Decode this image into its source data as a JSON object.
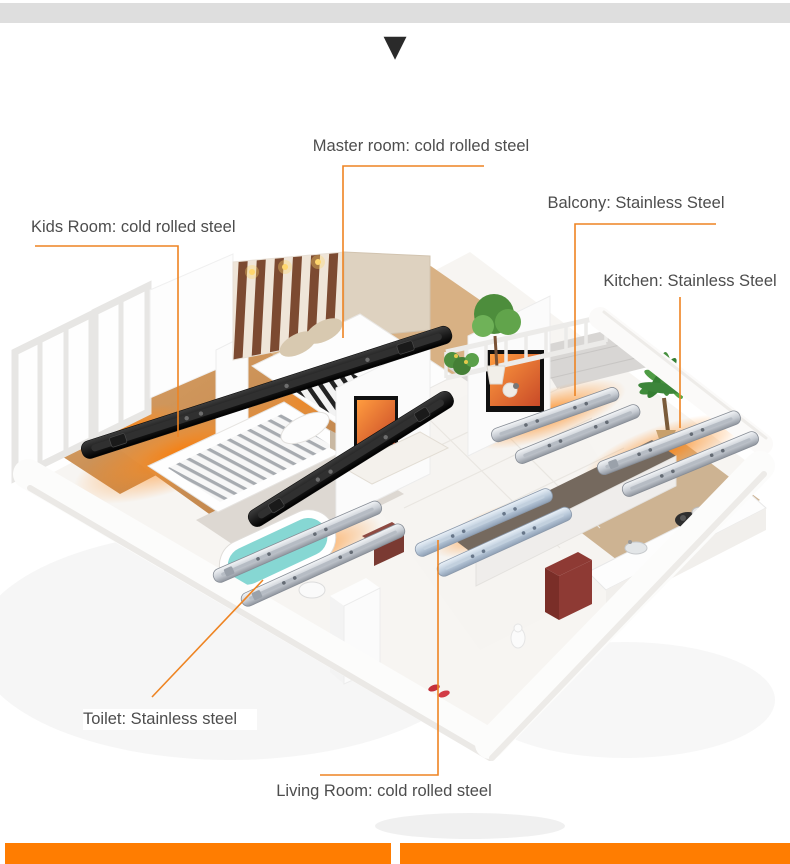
{
  "icons": {
    "scroll_down_arrow": "▼"
  },
  "labels": {
    "master_room": "Master room: cold rolled steel",
    "kids_room": "Kids Room: cold rolled steel",
    "balcony": "Balcony: Stainless Steel",
    "kitchen": "Kitchen: Stainless Steel",
    "toilet": "Toilet: Stainless steel",
    "living_room": "Living Room: cold rolled steel"
  },
  "colors": {
    "accent_orange": "#FF7D01",
    "leader_line_orange": "#EE8422",
    "label_text_gray": "#4D4D4D",
    "top_bar_gray": "#DEDEDE",
    "arrow_black": "#2A2A2A"
  }
}
